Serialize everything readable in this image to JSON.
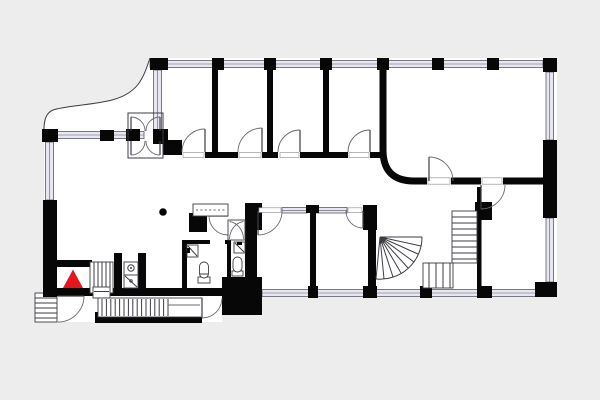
{
  "meta": {
    "kind": "architectural-floor-plan",
    "image_width": 600,
    "image_height": 400,
    "has_text": false
  },
  "colors": {
    "canvas_bg": "#ededee",
    "floor": "#ffffff",
    "wall": "#070707",
    "window_fill": "#e7e7f1",
    "window_line": "#5a5a64",
    "thin": "#3c3c44",
    "door_arc": "#6a6a72",
    "sill_line": "#96969e",
    "dash": "#666666",
    "marker": "#e5161c"
  },
  "legend": {
    "entrance_marker": {
      "shape": "red-triangle",
      "meaning": "entrance / you-are-here",
      "approx_x": 73,
      "approx_y": 279
    }
  },
  "elements": {
    "rooms": [
      "top-room-1",
      "top-room-2",
      "top-room-3",
      "top-room-4",
      "large-corner-room-curved-wall",
      "central-hall",
      "wc-lobby",
      "wc-1",
      "wc-2",
      "south-room-1",
      "south-room-2",
      "south-east-room",
      "entry-vestibule"
    ],
    "stairs": [
      "exterior-entry-steps",
      "entry-ramp-stair",
      "entry-inner-steps",
      "fan-winder-staircase",
      "l-shaped-staircase"
    ],
    "fixtures": [
      "toilet-1",
      "toilet-2",
      "washbasin-1",
      "washbasin-2",
      "shower-cabin",
      "sink-shower-unit",
      "structural-column",
      "counter-desk"
    ],
    "doorway_count": 13,
    "window_facades": [
      "north",
      "east-upper",
      "east-lower",
      "west-wing",
      "west-lower",
      "south"
    ]
  }
}
